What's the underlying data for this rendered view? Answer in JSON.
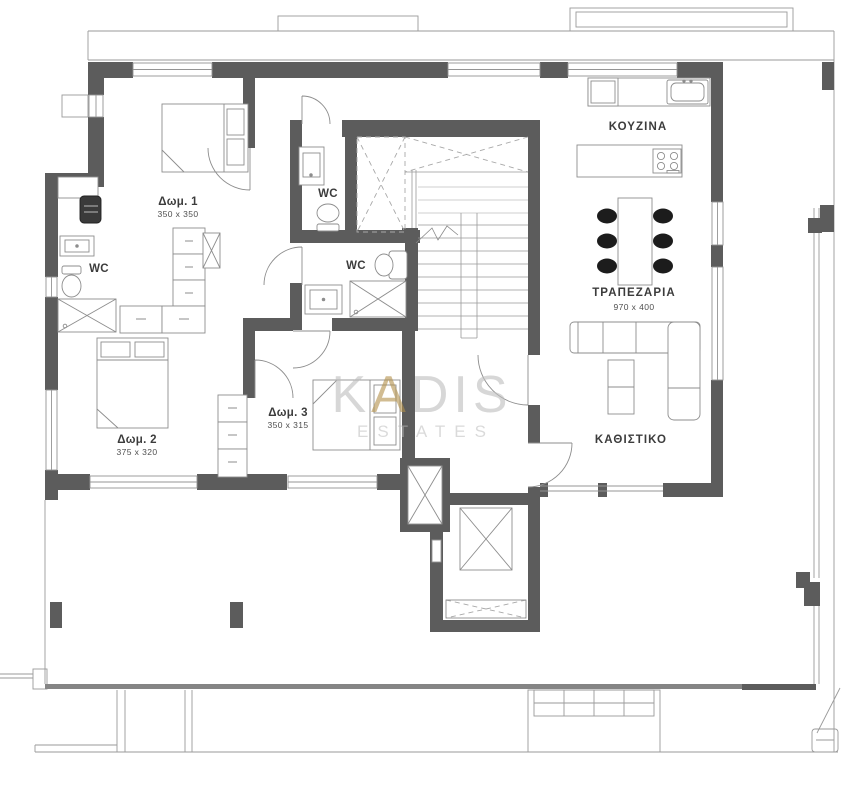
{
  "plan": {
    "watermark": {
      "part1": "K",
      "part2": "A",
      "part3": "DIS",
      "subtitle": "ESTATES"
    },
    "rooms": {
      "bedroom1": {
        "name": "Δωμ. 1",
        "dims": "350 x 350"
      },
      "bedroom2": {
        "name": "Δωμ. 2",
        "dims": "375 x 320"
      },
      "bedroom3": {
        "name": "Δωμ. 3",
        "dims": "350 x 315"
      },
      "kitchen": {
        "name": "ΚΟΥΖΙΝΑ"
      },
      "dining": {
        "name": "ΤΡΑΠΕΖΑΡΙΑ",
        "dims": "970 x 400"
      },
      "living": {
        "name": "ΚΑΘΙΣΤΙΚΟ"
      },
      "wc_left": {
        "name": "WC"
      },
      "wc_top": {
        "name": "WC"
      },
      "wc_mid": {
        "name": "WC"
      }
    },
    "colors": {
      "wall": "#5c5c5c",
      "line": "#9a9a9a",
      "furniture": "#8d8d8d",
      "chair": "#1c1c1c",
      "watermark": "#bdbdbd",
      "accent_gold": "#b3904a"
    }
  }
}
